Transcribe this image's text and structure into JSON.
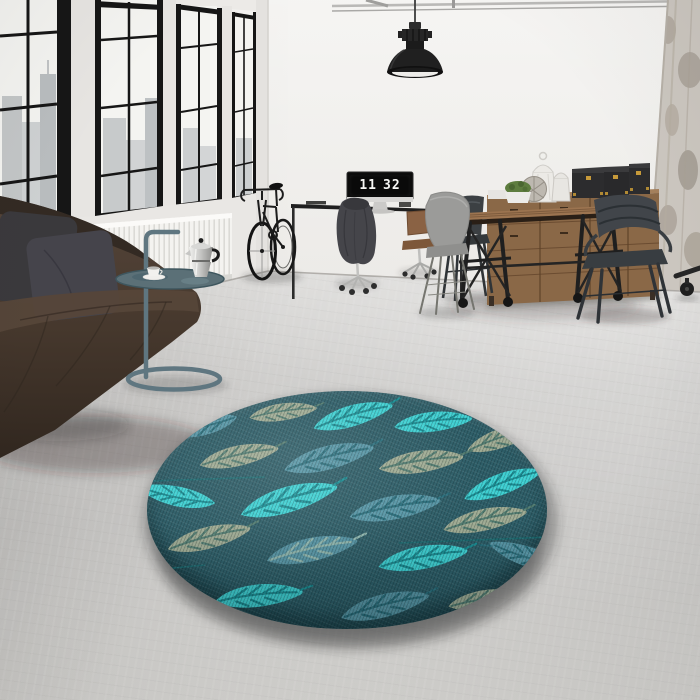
{
  "title": "Bright loft interior with a round teal leaf-pattern rug",
  "clock": {
    "hours": "11",
    "minutes": "32"
  },
  "palette": {
    "wall": "#ecebe8",
    "floor": "#cccbc9",
    "window_frame": "#161616",
    "sofa_leather": "#46392e",
    "radiator": "#f3f2ef",
    "wood": "#8a6847",
    "metal_chair": "#3d4247",
    "side_table": "#5f7680",
    "rug_background": "#2e5e68",
    "rug_leaf_cyan": "#3ed0d2",
    "rug_leaf_sage": "#9fab93",
    "rug_leaf_teal": "#5695a5"
  },
  "objects": [
    {
      "name": "industrial-windows",
      "label": "Black-framed windows with city view"
    },
    {
      "name": "radiator",
      "label": "White panel radiator"
    },
    {
      "name": "sofa",
      "label": "Dark leather sofa with gray cushions"
    },
    {
      "name": "side-table",
      "label": "Round tray table with moka pot and cup"
    },
    {
      "name": "bicycle",
      "label": "Black road bicycle"
    },
    {
      "name": "pendant-lamp",
      "label": "Black industrial pendant lamp"
    },
    {
      "name": "desk",
      "label": "Wall desk with monitor flip clock"
    },
    {
      "name": "dining-table",
      "label": "Industrial wooden table on casters"
    },
    {
      "name": "sideboard",
      "label": "Wooden sideboard with storage boxes and lanterns"
    },
    {
      "name": "rug",
      "label": "Round teal rug with leaf pattern"
    },
    {
      "name": "column",
      "label": "Distressed concrete column"
    }
  ],
  "rug": {
    "shape": "round",
    "pattern": "leaves",
    "leaf_count": 20
  }
}
